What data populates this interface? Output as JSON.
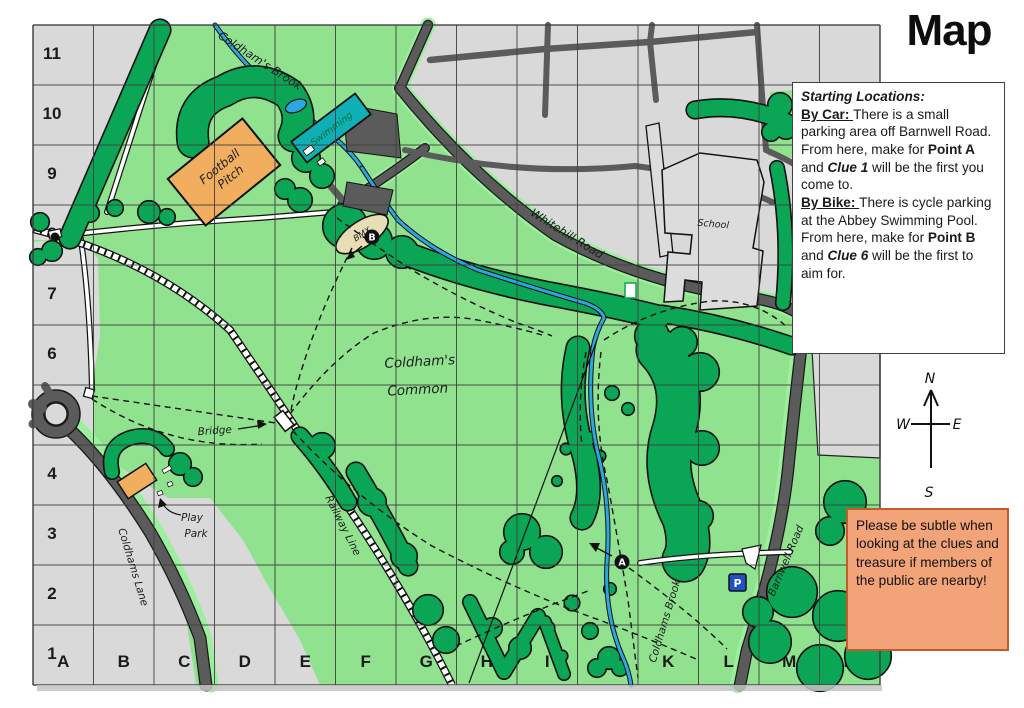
{
  "page": {
    "title": "Map"
  },
  "grid": {
    "column_labels": [
      "A",
      "B",
      "C",
      "D",
      "E",
      "F",
      "G",
      "H",
      "I",
      "J",
      "K",
      "L",
      "M",
      "N"
    ],
    "row_labels": [
      "1",
      "2",
      "3",
      "4",
      "5",
      "6",
      "7",
      "8",
      "9",
      "10",
      "11"
    ]
  },
  "map_labels": {
    "coldhams_brook_top": "Coldham's Brook",
    "swimming": "Swimming",
    "football_line1": "Football",
    "football_line2": "Pitch",
    "bmx": "BMX",
    "whitehill_road": "Whitehill Road",
    "school": "School",
    "common_line1": "Coldham's",
    "common_line2": "Common",
    "bridge": "Bridge",
    "play_line1": "Play",
    "play_line2": "Park",
    "coldhams_lane": "Coldhams Lane",
    "railway_line": "Railway Line",
    "coldhams_brook_bottom": "Coldhams Brook",
    "barnwell_road": "Barnwell Road"
  },
  "markers": {
    "point_a": "A",
    "point_b": "B",
    "parking": "P"
  },
  "compass": {
    "north": "N",
    "east": "E",
    "south": "S",
    "west": "W"
  },
  "starting_box": {
    "segments": [
      {
        "text": "Starting Locations:",
        "bold": true,
        "italic": true,
        "br": true
      },
      {
        "text": "By Car: ",
        "bold": true,
        "underline": true
      },
      {
        "text": "There is a small parking area off Barnwell Road. From here, make for "
      },
      {
        "text": "Point A",
        "bold": true
      },
      {
        "text": " and "
      },
      {
        "text": "Clue 1",
        "bold": true,
        "italic": true
      },
      {
        "text": " will be the first you come to.",
        "br": true
      },
      {
        "text": "By Bike: ",
        "bold": true,
        "underline": true
      },
      {
        "text": "There is cycle parking at the Abbey Swimming Pool. From here, make for "
      },
      {
        "text": "Point B",
        "bold": true
      },
      {
        "text": " and "
      },
      {
        "text": "Clue 6",
        "bold": true,
        "italic": true
      },
      {
        "text": " will be the first to aim for."
      }
    ]
  },
  "notice_box": {
    "text": "Please be subtle when looking at the clues and treasure if members of the public are nearby!"
  },
  "colors": {
    "common_green": "#90E28E",
    "verge_green": "#9CEF9C",
    "tree_green": "#0AA655",
    "urban_grey": "#D9D9D9",
    "road_grey": "#5B5B5B",
    "brook_blue": "#29A8E2",
    "pool_teal": "#10AFB5",
    "pitch_orange": "#F2AE5F",
    "bmx_tan": "#E8DEB6",
    "notice_fill": "#F2A478",
    "notice_border": "#C05B2A",
    "parking_blue": "#2050C8"
  }
}
